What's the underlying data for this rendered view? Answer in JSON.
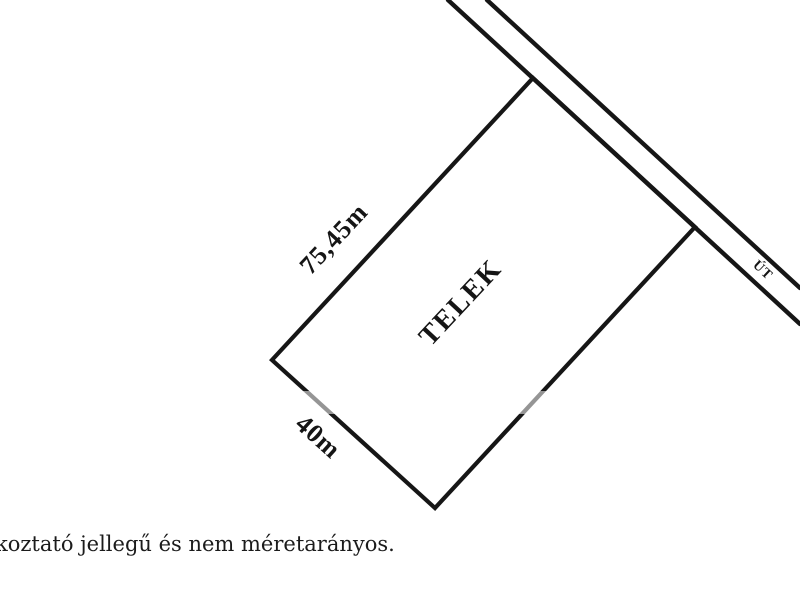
{
  "diagram": {
    "title_hint": "land parcel sketch",
    "plot_label": "TELEK",
    "dimension_long": "75,45m",
    "dimension_short": "40m",
    "road_label": "ÚT",
    "footnote_visible": "koztató jellegű és nem méretarányos.",
    "colors": {
      "line": "#161616",
      "text": "#151515",
      "background": "#ffffff"
    }
  }
}
